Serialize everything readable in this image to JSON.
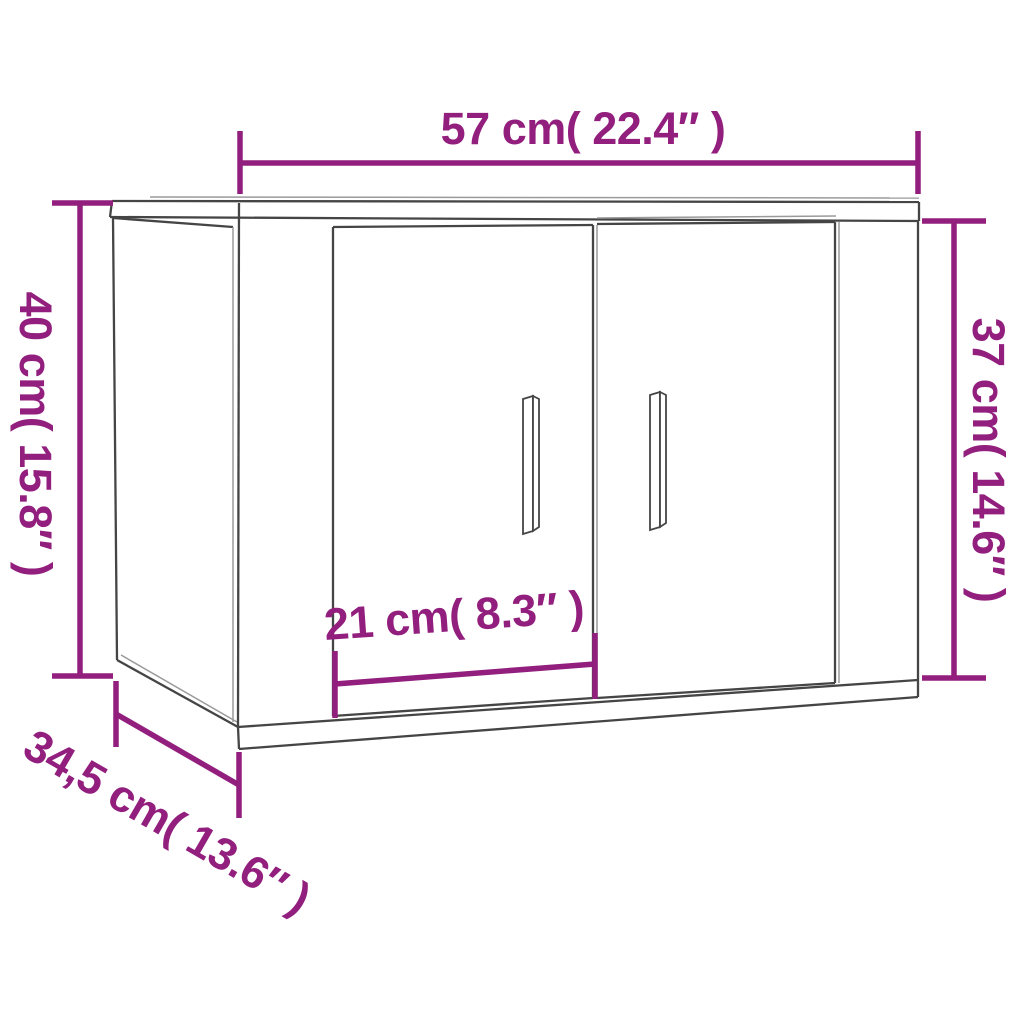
{
  "colors": {
    "bg": "#ffffff",
    "accent": "#921e7d",
    "line-dark": "#454545",
    "line-light": "#9a9a9a"
  },
  "diagram": {
    "subject": "wall-cabinet-with-two-doors",
    "dimensions": [
      {
        "id": "width-top",
        "label": "57 cm( 22.4″ )",
        "cm": 57,
        "inches": 22.4,
        "position": "top",
        "orientation": "horizontal"
      },
      {
        "id": "height-left",
        "label": "40 cm( 15.8″ )",
        "cm": 40,
        "inches": 15.8,
        "position": "left",
        "orientation": "vertical"
      },
      {
        "id": "height-right",
        "label": "37 cm( 14.6″ )",
        "cm": 37,
        "inches": 14.6,
        "position": "right",
        "orientation": "vertical"
      },
      {
        "id": "door-width",
        "label": "21 cm( 8.3″ )",
        "cm": 21,
        "inches": 8.3,
        "position": "bottom-front",
        "orientation": "horizontal"
      },
      {
        "id": "depth",
        "label": "34,5 cm( 13.6″ )",
        "cm": 34.5,
        "inches": 13.6,
        "position": "bottom-left",
        "orientation": "diagonal"
      }
    ]
  }
}
